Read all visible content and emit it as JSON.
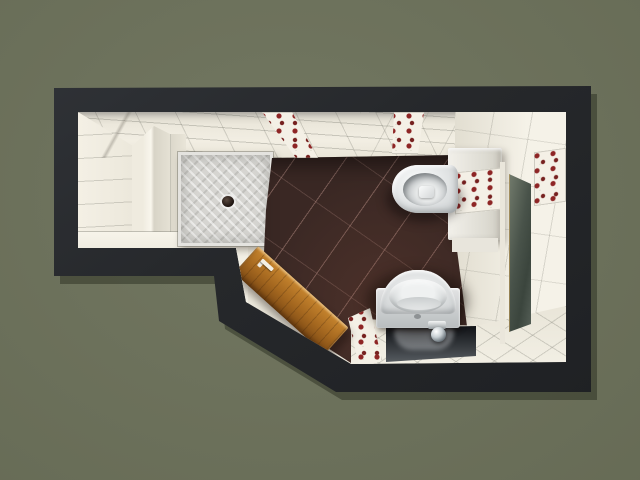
{
  "scene": {
    "label": "bathroom-floor-plan-top-down-3d-render"
  },
  "colors": {
    "canvas": "#6d725b",
    "wall": "#26282b",
    "tile": "#ece8dc",
    "tile-bright": "#f7f4ea",
    "floor": "#3a2824",
    "tray": "#d6d5d1",
    "ceramic": "#e9ebec",
    "chrome": "#c8cfd3",
    "wood": "#a4671f",
    "wood-frame": "#96622a",
    "glass": "#49534a",
    "deco-base": "#f4f0e6",
    "deco-red": "#8e2525",
    "deco-leaf": "#5c6a45",
    "mirror": "#101216"
  },
  "fixtures": [
    {
      "name": "shower-tray"
    },
    {
      "name": "shower-drain"
    },
    {
      "name": "wall-hung-toilet"
    },
    {
      "name": "cistern-box"
    },
    {
      "name": "washbasin"
    },
    {
      "name": "faucet"
    },
    {
      "name": "mirror"
    },
    {
      "name": "wood-interior-door"
    },
    {
      "name": "right-wall-door"
    },
    {
      "name": "decor-tile-strips"
    }
  ]
}
